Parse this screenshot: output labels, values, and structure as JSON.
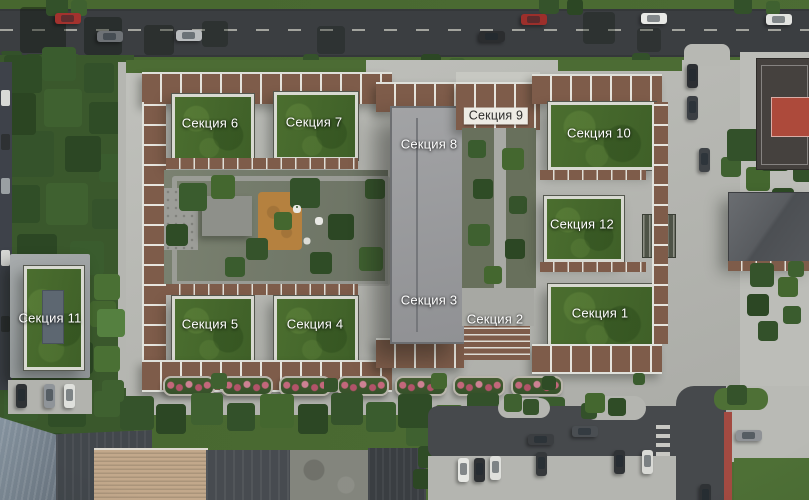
{
  "scene": {
    "description": "Aerial 3D masterplan of a residential complex with numbered building sections",
    "language": "ru"
  },
  "sections": [
    {
      "id": "1",
      "label": "Секция 1",
      "x": 600,
      "y": 313,
      "variant": "on-roof"
    },
    {
      "id": "2",
      "label": "Секция 2",
      "x": 495,
      "y": 319,
      "variant": "on-roof"
    },
    {
      "id": "3",
      "label": "Секция 3",
      "x": 429,
      "y": 300,
      "variant": "on-roof"
    },
    {
      "id": "4",
      "label": "Секция 4",
      "x": 315,
      "y": 324,
      "variant": "on-roof"
    },
    {
      "id": "5",
      "label": "Секция 5",
      "x": 210,
      "y": 324,
      "variant": "on-roof"
    },
    {
      "id": "6",
      "label": "Секция 6",
      "x": 210,
      "y": 123,
      "variant": "on-roof"
    },
    {
      "id": "7",
      "label": "Секция 7",
      "x": 314,
      "y": 122,
      "variant": "on-roof"
    },
    {
      "id": "8",
      "label": "Секция 8",
      "x": 429,
      "y": 144,
      "variant": "on-roof"
    },
    {
      "id": "9",
      "label": "Секция 9",
      "x": 496,
      "y": 116,
      "variant": "badge"
    },
    {
      "id": "10",
      "label": "Секция 10",
      "x": 599,
      "y": 133,
      "variant": "on-roof"
    },
    {
      "id": "11",
      "label": "Секция 11",
      "x": 50,
      "y": 318,
      "variant": "on-roof"
    },
    {
      "id": "12",
      "label": "Секция 12",
      "x": 582,
      "y": 224,
      "variant": "on-roof"
    }
  ],
  "palette": {
    "roadAsphalt": "#3b3e41",
    "roadLine": "#c6c6bd",
    "grass": "#4c6c34",
    "parkGreen": "#3a582c",
    "plaza": "#b6b7b2",
    "pavement": "#bcbdb8",
    "brick": "#7e5c4a",
    "parapet": "#dfe0da",
    "greenRoofDark": "#3f6028",
    "greenRoofLight": "#4b6e2f",
    "slabRoof": "#9a9b9e",
    "courtyard": "#6b7263",
    "playground": "#b5813f",
    "planterFlower": "#c3677b",
    "asphaltLot": "#46494c",
    "redLane": "#a34a41",
    "courtRed": "#ad4a3b",
    "courtDark": "#45413e",
    "lawn": "#4e7036",
    "tanRoof": "#c2a88b",
    "blueRoof": "#7b8894",
    "darkRoof": "#42474c",
    "stoneRoof": "#83857d",
    "labelText": "#ffffff",
    "badgeBg": "#edebe4",
    "badgeText": "#2d2d2b"
  }
}
